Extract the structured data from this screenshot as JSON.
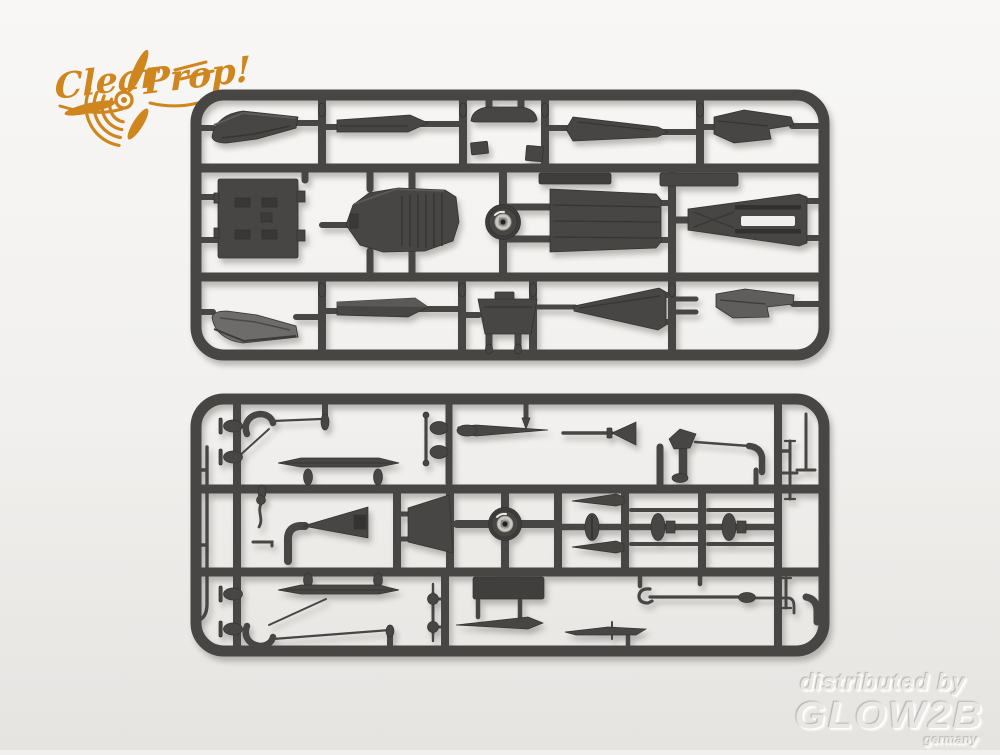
{
  "logo": {
    "word1": "Clear",
    "word2": "Prop!",
    "color": "#cf861e"
  },
  "watermark": {
    "line1": "distributed by",
    "brand": "GLOW2B",
    "country": "germany"
  },
  "colors": {
    "background_top": "#f8f7f5",
    "background_mid": "#f1f0ee",
    "background_bottom": "#e5e4e1",
    "sprue": "#474645",
    "sprue_dark": "#343332",
    "sprue_light": "#6d6c6a",
    "hub_silver": "#c9c7c2"
  },
  "sprues": {
    "count": "2"
  },
  "icons": {
    "logo_mark": "propeller-icon"
  }
}
